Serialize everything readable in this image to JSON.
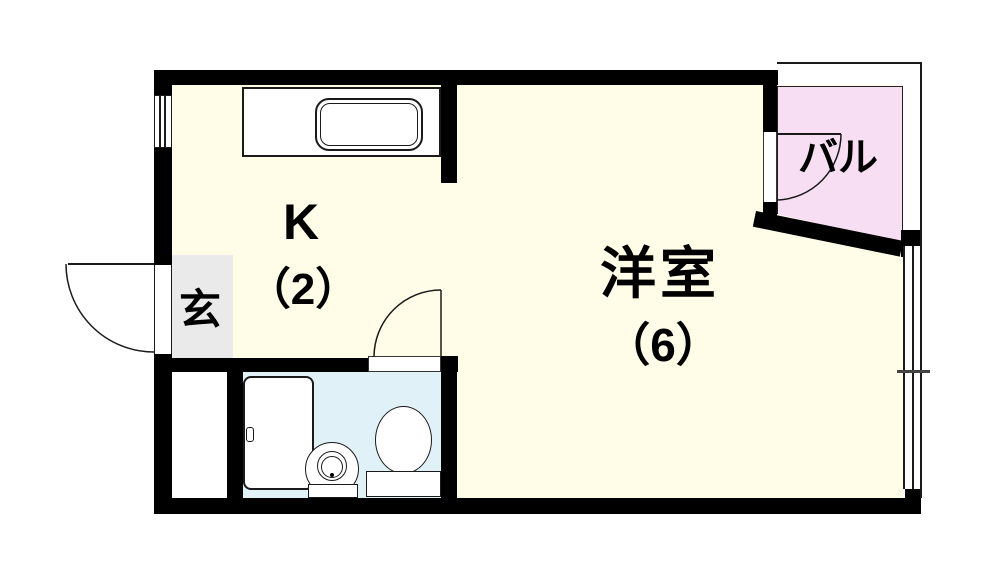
{
  "floor_plan": {
    "type": "apartment-floor-plan",
    "rooms": {
      "kitchen": {
        "label": "K",
        "size": "（2）"
      },
      "western_room": {
        "label": "洋室",
        "size": "（6）"
      },
      "entrance": {
        "label": "玄"
      },
      "balcony": {
        "label": "バル"
      }
    },
    "fixtures": [
      "kitchen-sink",
      "bathtub",
      "washbasin",
      "toilet",
      "entrance-door",
      "bathroom-door",
      "balcony-door",
      "window-left",
      "window-right"
    ],
    "colors": {
      "wall": "#000000",
      "floor": "#FFFDE8",
      "balcony": "#F7DEF2",
      "bathroom": "#E0F1F8",
      "entrance": "#EAEAEA",
      "line": "#1a1a1a",
      "background": "#FFFFFF",
      "text": "#000000"
    }
  }
}
